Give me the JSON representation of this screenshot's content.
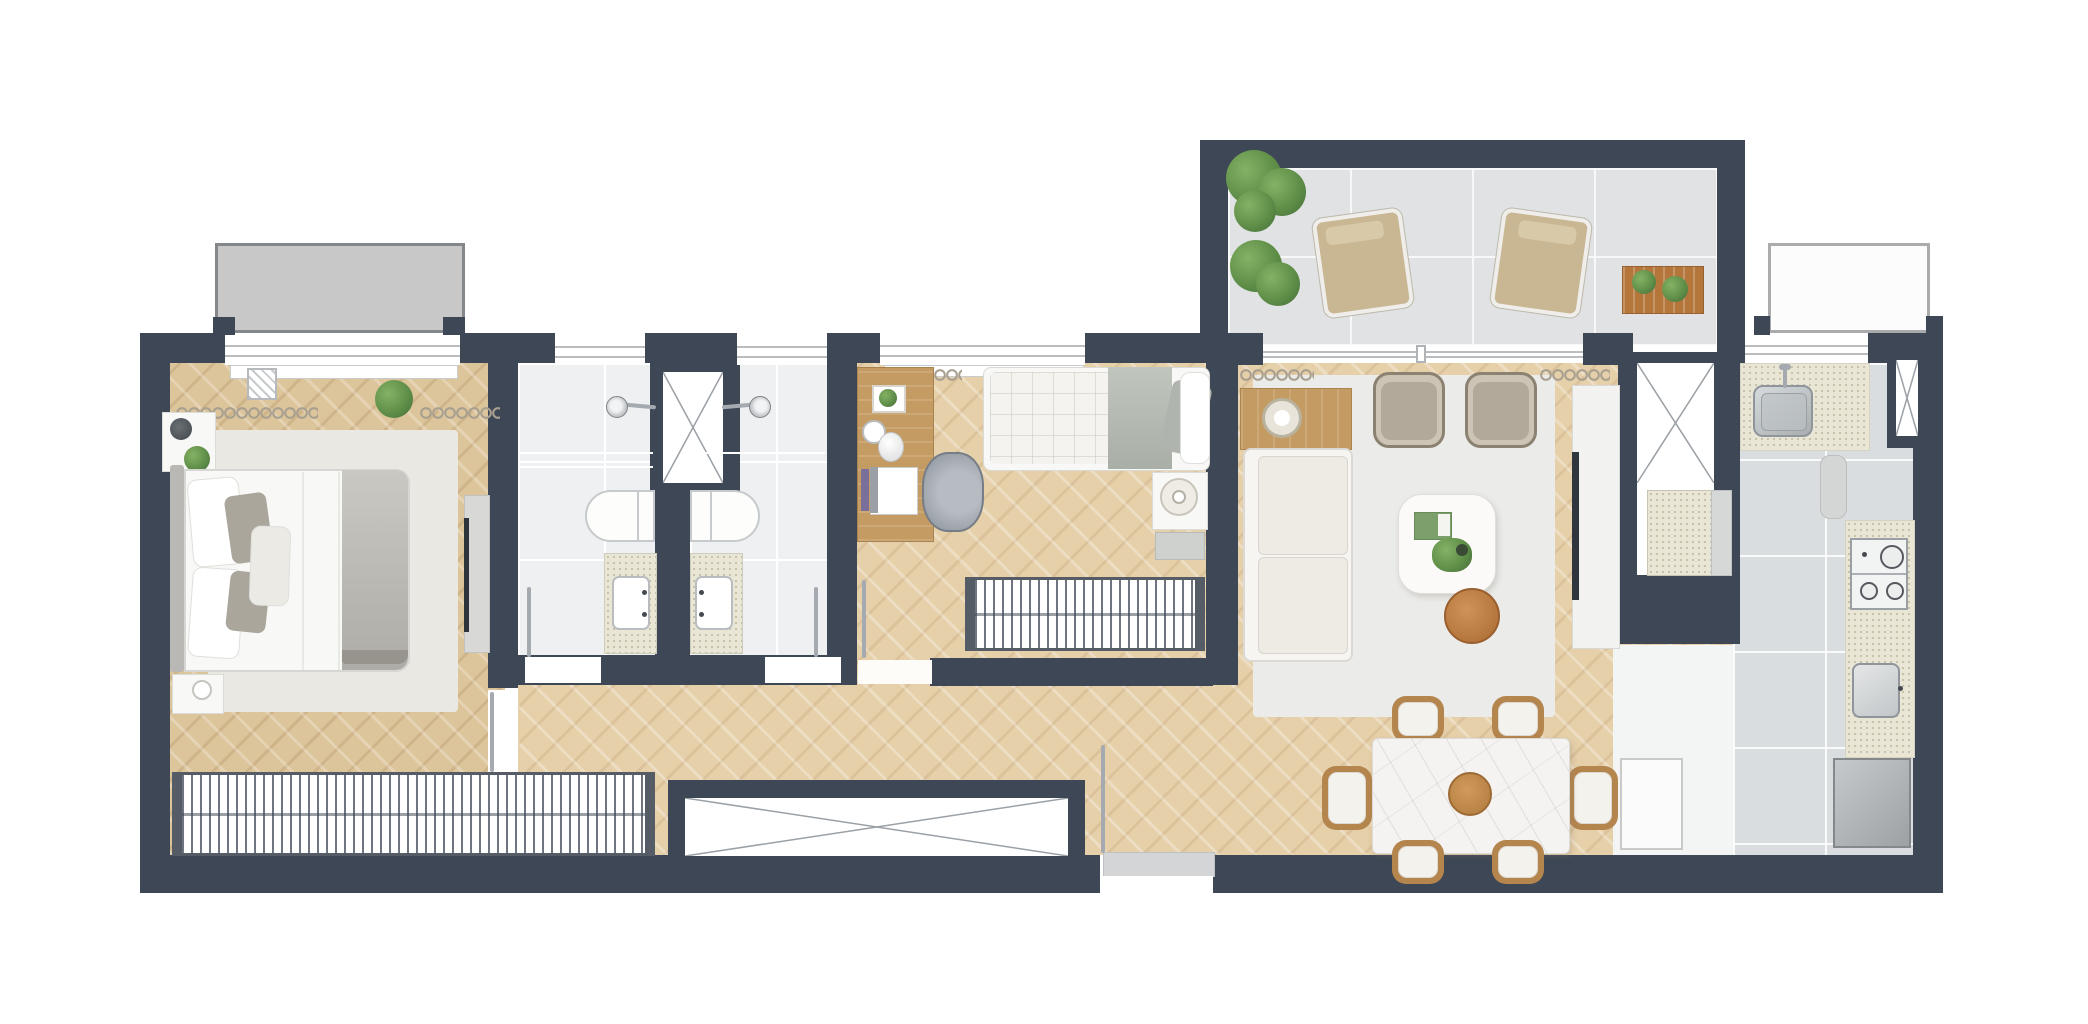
{
  "meta": {
    "title": "apartment-floor-plan",
    "canvas_width": 2088,
    "canvas_height": 1024,
    "style": "top-down rendered architectural plan, no text labels"
  },
  "palette": {
    "wall": "#3e4755",
    "wood": "#e6d0aa",
    "wood2": "#dcc49b",
    "bath": "#eef0f1",
    "kitTile": "#dadddf",
    "terr": "#e0e2e3",
    "rug": "#eae8e3",
    "rugL": "#ebebe9",
    "white": "#f8f8f6",
    "counter": "#e9e6d6",
    "chrome": "#a4aab0",
    "appl": "#b7babc",
    "deskwood": "#c49c63",
    "chairwood": "#b5854e",
    "sidet": "#b5763c",
    "green": "#5d8c47",
    "blanket": "#bcbab4",
    "cushion": "#b3a99b",
    "tan": "#cdc4b6",
    "marble": "#f4f3f1",
    "ledge": "#c7c8c7",
    "svcfloor": "#f3f4f4",
    "grout": "#ffffff"
  },
  "counts": {
    "bedrooms": 2,
    "bathrooms": 2,
    "dining_chairs": 6,
    "cooktop_burners": 4,
    "lounge_chairs": 2,
    "armchairs": 2,
    "shafts": 4
  },
  "rooms": [
    {
      "name": "Master Bedroom",
      "floor": "herringbone wood",
      "furniture": [
        "double-bed",
        "headboard",
        "nightstand-with-lamp",
        "nightstand-with-cup",
        "plant",
        "rug",
        "hanger-wardrobe",
        "tv-cabinet",
        "curtains",
        "ac-unit",
        "window",
        "balcony-ledge"
      ]
    },
    {
      "name": "Bathroom 1",
      "floor": "light tile",
      "furniture": [
        "shower-head",
        "bathtub",
        "vanity-counter",
        "sink",
        "door-leaf",
        "window"
      ]
    },
    {
      "name": "Bathroom 2",
      "floor": "light tile",
      "furniture": [
        "shower-head",
        "bathtub",
        "vanity-counter",
        "sink",
        "door-leaf",
        "window"
      ]
    },
    {
      "name": "Bedroom 2",
      "floor": "herringbone wood",
      "furniture": [
        "desk",
        "framed-art",
        "desk-mirror-lamp",
        "laptop",
        "book",
        "office-chair",
        "single-bed",
        "nightstand-with-tray",
        "stool",
        "clothes-rack",
        "curtain",
        "window"
      ]
    },
    {
      "name": "Hallway",
      "floor": "herringbone wood",
      "furniture": [
        "crossed-storage-box"
      ]
    },
    {
      "name": "Living Room",
      "floor": "rug over wood",
      "furniture": [
        "sofa",
        "console-with-tray",
        "armchair",
        "armchair",
        "coffee-table",
        "green-book",
        "potted-plant",
        "round-side-table",
        "tv-panel",
        "media-cabinet",
        "curtains",
        "sliding-glass-window"
      ]
    },
    {
      "name": "Dining Area",
      "floor": "herringbone wood",
      "furniture": [
        "marble-dining-table",
        "wood-centerpiece-bowl",
        "dining-chair",
        "dining-chair",
        "dining-chair",
        "dining-chair",
        "dining-chair",
        "dining-chair"
      ]
    },
    {
      "name": "Kitchen",
      "floor": "grey tile",
      "furniture": [
        "counter-with-sink",
        "faucet",
        "cutting-board",
        "counter-right",
        "gas-cooktop",
        "laundry-sink",
        "washing-machine",
        "white-cabinet",
        "window",
        "shaft"
      ]
    },
    {
      "name": "Terrace",
      "floor": "grey tile",
      "furniture": [
        "planter-bush",
        "planter-bush",
        "lounge-chair",
        "lounge-chair",
        "slat-wood-table",
        "potted-plant",
        "potted-plant"
      ]
    },
    {
      "name": "Service Column",
      "furniture": [
        "x-shaft",
        "equipment-unit"
      ]
    },
    {
      "name": "Entry",
      "furniture": [
        "threshold",
        "door-leaf"
      ]
    }
  ]
}
